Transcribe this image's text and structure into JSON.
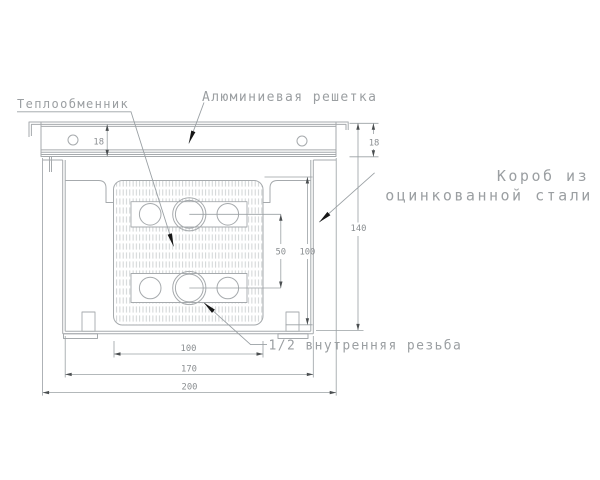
{
  "labels": {
    "heat_exchanger": "Теплообменник",
    "aluminum_grille": "Алюминиевая решетка",
    "steel_box_line1": "Короб из",
    "steel_box_line2": "оцинкованной стали",
    "thread": "1/2 внутренняя резьба"
  },
  "dimensions": {
    "grille_height": "18",
    "overall_height": "140",
    "inner_height": "100",
    "tube_row_spacing": "50",
    "exchanger_width": "100",
    "box_width": "170",
    "overall_width": "200"
  },
  "colors": {
    "background": "#ffffff",
    "line": "#a6aaad",
    "dim_line": "#9aa0a4",
    "hatch": "#c8cccd",
    "label_text": "#9b9fa2",
    "dim_text": "#8b8f92",
    "leader_arrow": "#161616"
  }
}
